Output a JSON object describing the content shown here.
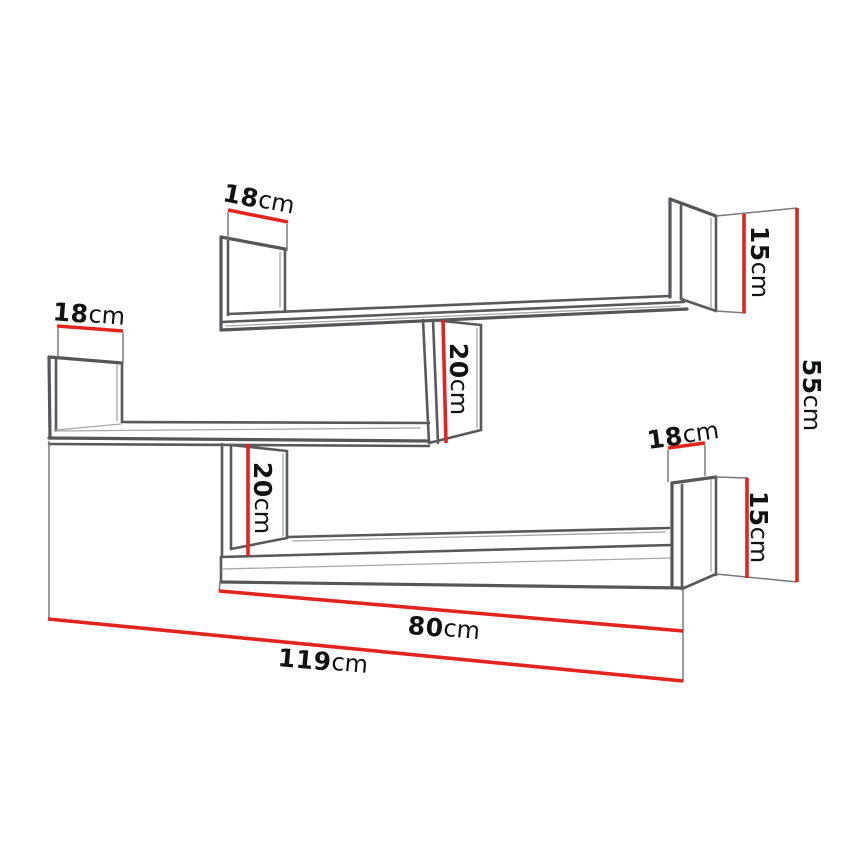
{
  "diagram": {
    "kind": "furniture-dimension-drawing",
    "subject": "zigzag wall shelf unit, perspective line drawing",
    "background_color": "#ffffff",
    "outline_color": "#58595b",
    "dimension_line_color": "#e2241f",
    "label_color": "#121213",
    "unit": "cm",
    "dimensions": [
      {
        "id": "upper-shelf-left-depth",
        "value": "18",
        "unit": "cm",
        "orientation": "slanted-horizontal"
      },
      {
        "id": "middle-shelf-left-depth",
        "value": "18",
        "unit": "cm",
        "orientation": "slanted-horizontal"
      },
      {
        "id": "upper-connector-height",
        "value": "20",
        "unit": "cm",
        "orientation": "vertical"
      },
      {
        "id": "upper-right-end-height",
        "value": "15",
        "unit": "cm",
        "orientation": "vertical"
      },
      {
        "id": "overall-height",
        "value": "55",
        "unit": "cm",
        "orientation": "vertical"
      },
      {
        "id": "bottom-shelf-right-depth",
        "value": "18",
        "unit": "cm",
        "orientation": "slanted-horizontal"
      },
      {
        "id": "bottom-right-end-height",
        "value": "15",
        "unit": "cm",
        "orientation": "vertical"
      },
      {
        "id": "lower-connector-height",
        "value": "20",
        "unit": "cm",
        "orientation": "vertical"
      },
      {
        "id": "bottom-shelf-length",
        "value": "80",
        "unit": "cm",
        "orientation": "slanted-horizontal"
      },
      {
        "id": "overall-width",
        "value": "119",
        "unit": "cm",
        "orientation": "slanted-horizontal"
      }
    ]
  }
}
